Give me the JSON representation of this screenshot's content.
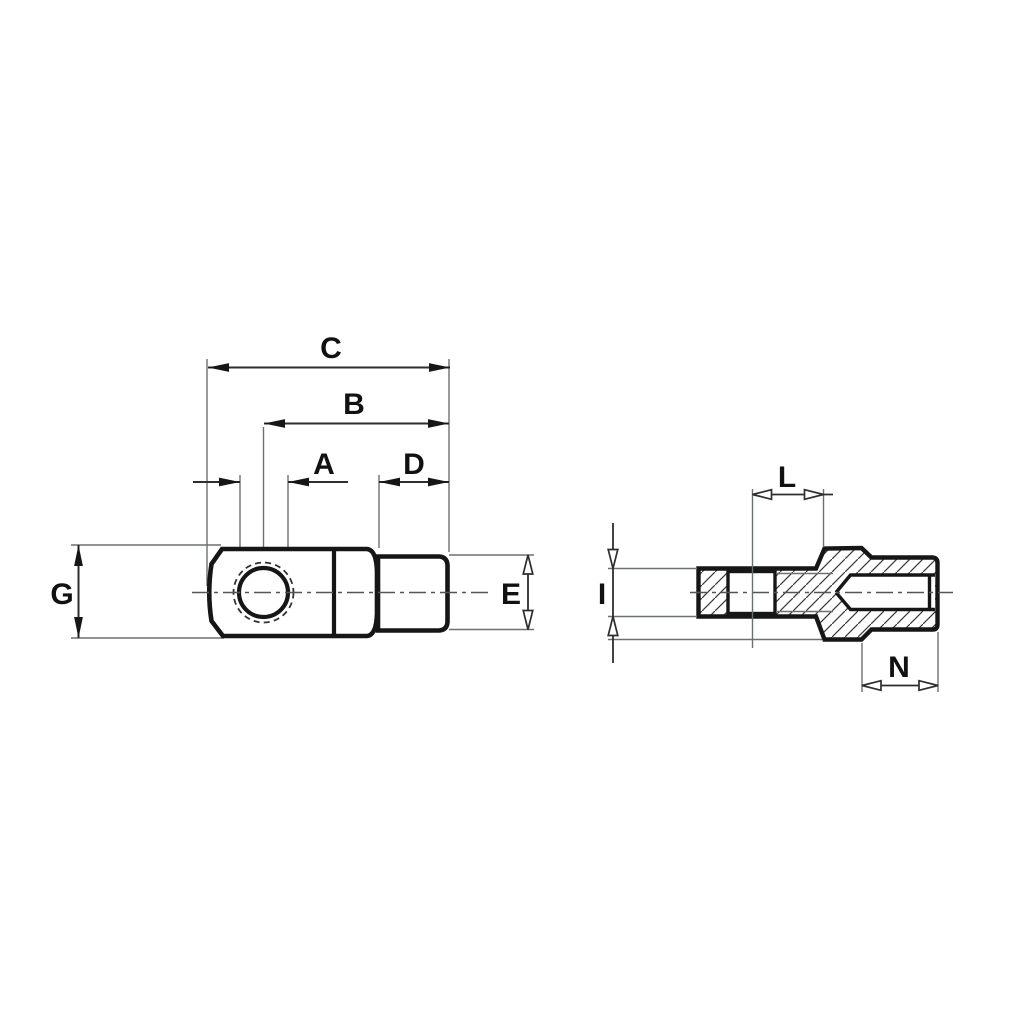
{
  "drawing": {
    "type": "two-view-technical-drawing",
    "colors": {
      "paper": "#ffffff",
      "ink": "#161616",
      "dim": "#2e2e2e",
      "thin": "#6b7070",
      "center": "#555555"
    },
    "front_view": {
      "dim_labels": {
        "c": "C",
        "b": "B",
        "a": "A",
        "d": "D",
        "g": "G",
        "e": "E"
      }
    },
    "side_view": {
      "dim_labels": {
        "l": "L",
        "i": "I",
        "n": "N"
      }
    }
  }
}
